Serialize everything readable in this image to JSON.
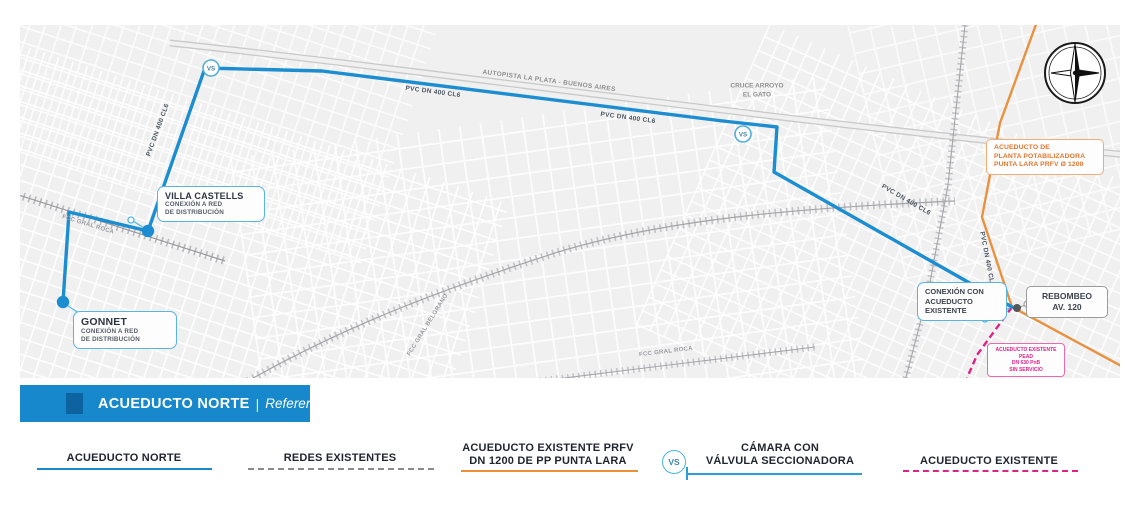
{
  "banner": {
    "title": "ACUEDUCTO NORTE",
    "separator": "|",
    "subtitle": "Referencias"
  },
  "map": {
    "pipe_label": "PVC DN 400 CL6",
    "autopista_label": "AUTOPISTA LA PLATA - BUENOS AIRES",
    "cruce_label_line1": "CRUCE ARROYO",
    "cruce_label_line2": "EL GATO",
    "railway_label_roca": "FCC GRAL ROCA",
    "railway_label_belgrano": "FCC GRAL BELGRANO",
    "railway_label_roca2": "FCC GRAL ROCA",
    "vs_symbol": "VS",
    "boxes": {
      "villa_castells": {
        "title": "VILLA CASTELLS",
        "line1": "CONEXIÓN A RED",
        "line2": "DE DISTRIBUCIÓN"
      },
      "gonnet": {
        "title": "GONNET",
        "line1": "CONEXIÓN A RED",
        "line2": "DE DISTRIBUCIÓN"
      },
      "planta": {
        "line1": "ACUEDUCTO DE",
        "line2": "PLANTA POTABILIZADORA",
        "line3": "PUNTA LARA PRFV Ø 1200"
      },
      "conexion": {
        "line1": "CONEXIÓN CON",
        "line2": "ACUEDUCTO",
        "line3": "EXISTENTE"
      },
      "rebombeo": {
        "line1": "REBOMBEO",
        "line2": "AV. 120"
      },
      "pead": {
        "line1": "ACUEDUCTO EXISTENTE PEAD",
        "line2": "DN 630 PnB",
        "line3": "SIN SERVICIO"
      }
    }
  },
  "legend": {
    "acueducto_norte": "ACUEDUCTO NORTE",
    "redes_existentes": "REDES EXISTENTES",
    "prfv_line1": "ACUEDUCTO EXISTENTE PRFV",
    "prfv_line2": "DN 1200 DE PP PUNTA LARA",
    "camara_symbol": "VS",
    "camara_line1": "CÁMARA CON",
    "camara_line2": "VÁLVULA SECCIONADORA",
    "acueducto_existente": "ACUEDUCTO EXISTENTE"
  },
  "colors": {
    "route_blue": "#1b8dd0",
    "leader_blue": "#56b9e3",
    "existing_orange": "#e8913f",
    "existing_pink": "#df2186",
    "banner_bg": "#1688cb",
    "banner_square": "#0d62a0",
    "legend_text": "#1f2430"
  }
}
